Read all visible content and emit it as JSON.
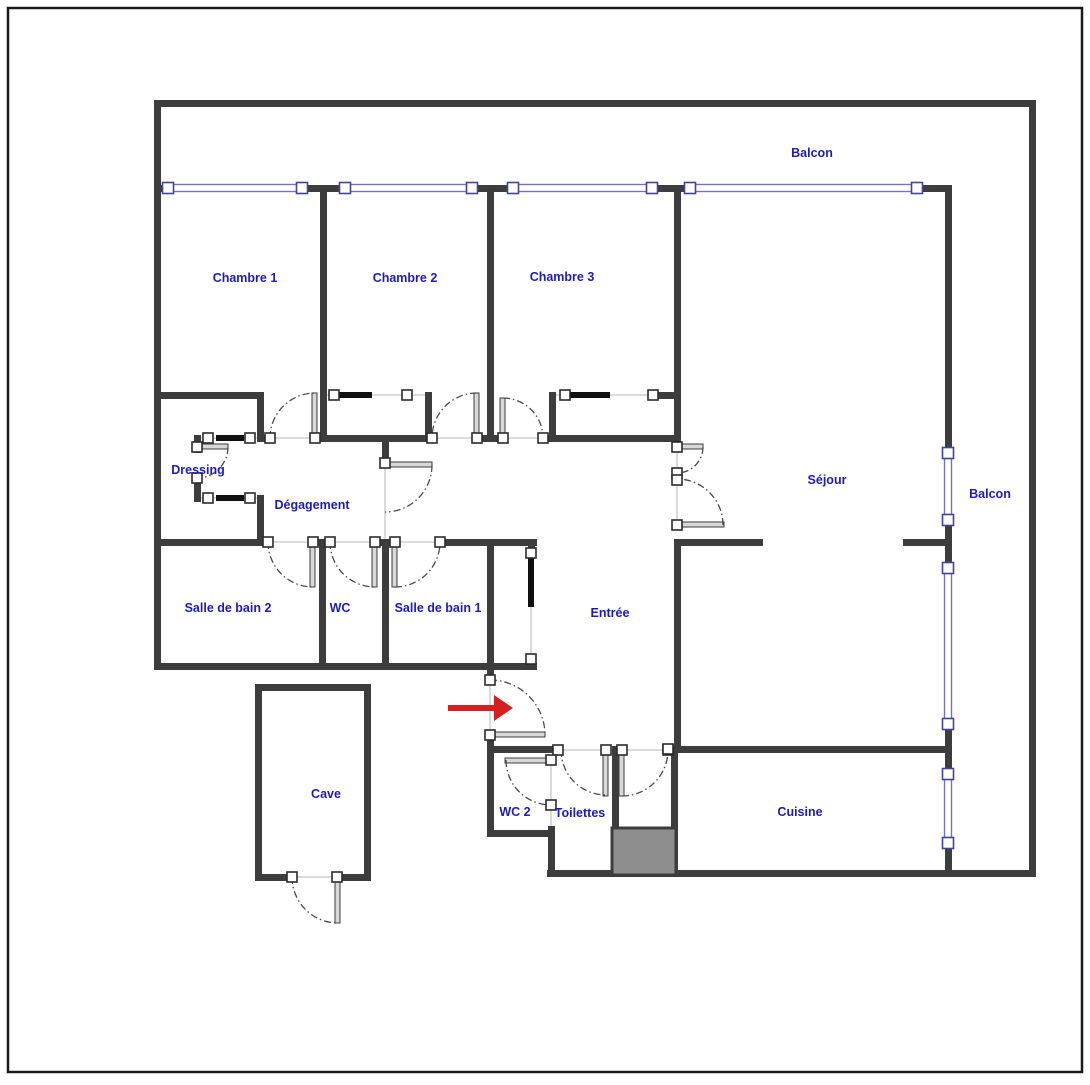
{
  "document_type": "apartment-floor-plan",
  "colors": {
    "background": "#ffffff",
    "frame": "#1a1a1a",
    "wall": "#3d3d3d",
    "window_line": "#7373c2",
    "window_handle_border": "#44449e",
    "handle_border": "#2b2b2b",
    "handle_fill": "#ffffff",
    "label": "#1b1bc4",
    "arc": "#4a4a4a",
    "thin_line": "#cfcfcf",
    "leaf_fill": "#d8d8d8",
    "leaf_border": "#3d3d3d",
    "closet_bar": "#101010",
    "shaft_fill": "#8e8e8e",
    "arrow": "#d42020"
  },
  "rooms": [
    {
      "id": "balcon-top",
      "label": "Balcon",
      "x": 812,
      "y": 157
    },
    {
      "id": "chambre-1",
      "label": "Chambre 1",
      "x": 245,
      "y": 282
    },
    {
      "id": "chambre-2",
      "label": "Chambre 2",
      "x": 405,
      "y": 282
    },
    {
      "id": "chambre-3",
      "label": "Chambre 3",
      "x": 562,
      "y": 281
    },
    {
      "id": "dressing",
      "label": "Dressing",
      "x": 198,
      "y": 474
    },
    {
      "id": "degagement",
      "label": "Dégagement",
      "x": 312,
      "y": 509
    },
    {
      "id": "sejour",
      "label": "Séjour",
      "x": 827,
      "y": 484
    },
    {
      "id": "balcon-right",
      "label": "Balcon",
      "x": 990,
      "y": 498
    },
    {
      "id": "salle-de-bain-2",
      "label": "Salle de bain 2",
      "x": 228,
      "y": 612
    },
    {
      "id": "wc",
      "label": "WC",
      "x": 340,
      "y": 612
    },
    {
      "id": "salle-de-bain-1",
      "label": "Salle de bain 1",
      "x": 438,
      "y": 612
    },
    {
      "id": "entree",
      "label": "Entrée",
      "x": 610,
      "y": 617
    },
    {
      "id": "cave",
      "label": "Cave",
      "x": 326,
      "y": 798
    },
    {
      "id": "wc-2",
      "label": "WC 2",
      "x": 515,
      "y": 816
    },
    {
      "id": "toilettes",
      "label": "Toilettes",
      "x": 580,
      "y": 817
    },
    {
      "id": "cuisine",
      "label": "Cuisine",
      "x": 800,
      "y": 816
    }
  ],
  "plan": {
    "canvas": {
      "width": 1090,
      "height": 1080
    },
    "frame": {
      "x": 8,
      "y": 8,
      "w": 1074,
      "h": 1064,
      "stroke_width": 2.5
    },
    "walls": [
      [
        154,
        100,
        882,
        7
      ],
      [
        154,
        100,
        7,
        570
      ],
      [
        1029,
        100,
        7,
        777
      ],
      [
        547,
        870,
        489,
        7
      ],
      [
        154,
        663,
        383,
        7
      ],
      [
        154,
        185,
        15,
        7
      ],
      [
        302,
        185,
        43,
        7
      ],
      [
        472,
        185,
        41,
        7
      ],
      [
        652,
        185,
        38,
        7
      ],
      [
        917,
        185,
        35,
        7
      ],
      [
        945,
        185,
        7,
        268
      ],
      [
        945,
        520,
        7,
        48
      ],
      [
        945,
        724,
        7,
        50
      ],
      [
        945,
        843,
        7,
        34
      ],
      [
        320,
        185,
        7,
        257
      ],
      [
        487,
        185,
        7,
        257
      ],
      [
        674,
        185,
        7,
        263
      ],
      [
        257,
        435,
        13,
        7
      ],
      [
        315,
        435,
        117,
        7
      ],
      [
        475,
        435,
        28,
        7
      ],
      [
        543,
        435,
        138,
        7
      ],
      [
        154,
        392,
        110,
        7
      ],
      [
        257,
        392,
        7,
        50
      ],
      [
        257,
        495,
        7,
        51
      ],
      [
        194,
        435,
        7,
        18
      ],
      [
        194,
        480,
        7,
        22
      ],
      [
        154,
        539,
        114,
        7
      ],
      [
        313,
        539,
        17,
        7
      ],
      [
        373,
        539,
        20,
        7
      ],
      [
        438,
        539,
        99,
        7
      ],
      [
        319,
        539,
        7,
        131
      ],
      [
        382,
        539,
        7,
        131
      ],
      [
        487,
        539,
        7,
        141
      ],
      [
        487,
        731,
        7,
        106
      ],
      [
        528,
        539,
        7,
        17
      ],
      [
        528,
        655,
        7,
        15
      ],
      [
        382,
        435,
        7,
        31
      ],
      [
        674,
        539,
        89,
        7
      ],
      [
        903,
        539,
        49,
        7
      ],
      [
        674,
        539,
        7,
        213
      ],
      [
        668,
        746,
        284,
        7
      ],
      [
        671,
        746,
        7,
        131
      ],
      [
        612,
        746,
        7,
        86
      ],
      [
        487,
        746,
        72,
        7
      ],
      [
        548,
        826,
        7,
        51
      ],
      [
        487,
        830,
        68,
        7
      ],
      [
        255,
        684,
        116,
        7
      ],
      [
        255,
        684,
        7,
        197
      ],
      [
        364,
        684,
        7,
        197
      ],
      [
        255,
        874,
        41,
        7
      ],
      [
        334,
        874,
        37,
        7
      ],
      [
        425,
        392,
        7,
        47
      ],
      [
        549,
        392,
        7,
        47
      ],
      [
        655,
        392,
        19,
        7
      ]
    ],
    "windows": [
      [
        168,
        184.5,
        134,
        7
      ],
      [
        345,
        184.5,
        127,
        7
      ],
      [
        513,
        184.5,
        139,
        7
      ],
      [
        690,
        184.5,
        227,
        7
      ],
      [
        944.5,
        453,
        7,
        67
      ],
      [
        944.5,
        568,
        7,
        156
      ],
      [
        944.5,
        774,
        7,
        69
      ]
    ],
    "window_handles": [
      [
        168,
        188
      ],
      [
        302,
        188
      ],
      [
        345,
        188
      ],
      [
        472,
        188
      ],
      [
        513,
        188
      ],
      [
        652,
        188
      ],
      [
        690,
        188
      ],
      [
        917,
        188
      ],
      [
        948,
        453
      ],
      [
        948,
        520
      ],
      [
        948,
        568
      ],
      [
        948,
        724
      ],
      [
        948,
        774
      ],
      [
        948,
        843
      ]
    ],
    "thin_lines": [
      [
        270,
        438,
        315,
        438
      ],
      [
        432,
        438,
        477,
        438
      ],
      [
        503,
        438,
        543,
        438
      ],
      [
        268,
        542,
        313,
        542
      ],
      [
        330,
        542,
        375,
        542
      ],
      [
        395,
        542,
        440,
        542
      ],
      [
        385,
        465,
        385,
        542
      ],
      [
        677,
        447,
        677,
        525
      ],
      [
        197,
        438,
        260,
        438
      ],
      [
        197,
        498,
        260,
        498
      ],
      [
        326,
        395,
        425,
        395
      ],
      [
        555,
        395,
        672,
        395
      ],
      [
        531,
        553,
        531,
        659
      ],
      [
        490,
        680,
        490,
        735
      ],
      [
        551,
        760,
        551,
        826
      ],
      [
        558,
        750,
        668,
        750
      ],
      [
        292,
        877,
        337,
        877
      ]
    ],
    "closet_bars": [
      [
        216,
        435,
        28,
        6
      ],
      [
        216,
        495,
        28,
        6
      ],
      [
        337,
        392,
        35,
        6
      ],
      [
        570,
        392,
        40,
        6
      ],
      [
        528,
        557,
        6,
        50
      ]
    ],
    "door_leaves": [
      [
        312,
        393,
        5,
        45
      ],
      [
        474,
        393,
        5,
        45
      ],
      [
        500,
        398,
        5,
        40
      ],
      [
        310,
        542,
        5,
        45
      ],
      [
        372,
        542,
        5,
        45
      ],
      [
        392,
        542,
        5,
        45
      ],
      [
        388,
        462,
        44,
        5
      ],
      [
        679,
        444,
        24,
        5
      ],
      [
        679,
        522,
        45,
        5
      ],
      [
        199,
        444,
        29,
        5
      ],
      [
        492,
        732,
        53,
        5
      ],
      [
        505,
        758,
        46,
        5
      ],
      [
        603,
        751,
        5,
        45
      ],
      [
        619,
        751,
        5,
        45
      ],
      [
        335,
        879,
        5,
        44
      ]
    ],
    "door_arcs": [
      "M270,438 A45,45 0 0 1 315,393",
      "M477,393 A45,45 0 0 0 432,438",
      "M503,398 A40,40 0 0 1 543,438",
      "M268,542 A45,45 0 0 0 313,587",
      "M330,542 A45,45 0 0 0 375,587",
      "M395,587 A45,45 0 0 0 440,542",
      "M432,465 A47,47 0 0 1 385,512",
      "M703,447 A26,26 0 0 1 677,473",
      "M723,525 A46,46 0 0 0 677,479",
      "M228,447 A31,31 0 0 1 197,478",
      "M490,680 A55,55 0 0 1 545,735",
      "M506,760 A45,45 0 0 0 551,805",
      "M561,750 A45,45 0 0 0 606,795",
      "M622,796 A46,46 0 0 0 668,750",
      "M292,877 A46,46 0 0 0 338,923"
    ],
    "door_handles": [
      [
        270,
        438
      ],
      [
        315,
        438
      ],
      [
        432,
        438
      ],
      [
        477,
        438
      ],
      [
        503,
        438
      ],
      [
        543,
        438
      ],
      [
        268,
        542
      ],
      [
        313,
        542
      ],
      [
        330,
        542
      ],
      [
        375,
        542
      ],
      [
        395,
        542
      ],
      [
        440,
        542
      ],
      [
        385,
        463
      ],
      [
        677,
        447
      ],
      [
        677,
        473
      ],
      [
        677,
        480
      ],
      [
        677,
        525
      ],
      [
        208,
        438
      ],
      [
        250,
        438
      ],
      [
        208,
        498
      ],
      [
        250,
        498
      ],
      [
        197,
        447
      ],
      [
        197,
        478
      ],
      [
        334,
        395
      ],
      [
        407,
        395
      ],
      [
        565,
        395
      ],
      [
        653,
        395
      ],
      [
        531,
        553
      ],
      [
        531,
        659
      ],
      [
        490,
        680
      ],
      [
        490,
        735
      ],
      [
        558,
        750
      ],
      [
        606,
        750
      ],
      [
        622,
        750
      ],
      [
        668,
        750
      ],
      [
        551,
        760
      ],
      [
        551,
        805
      ],
      [
        292,
        877
      ],
      [
        337,
        877
      ],
      [
        668,
        749
      ]
    ],
    "shaft": [
      612,
      828,
      64,
      47
    ],
    "entrance_arrow": {
      "shaft": [
        448,
        705,
        46,
        6
      ],
      "head": "494,695 513,708 494,721"
    }
  }
}
